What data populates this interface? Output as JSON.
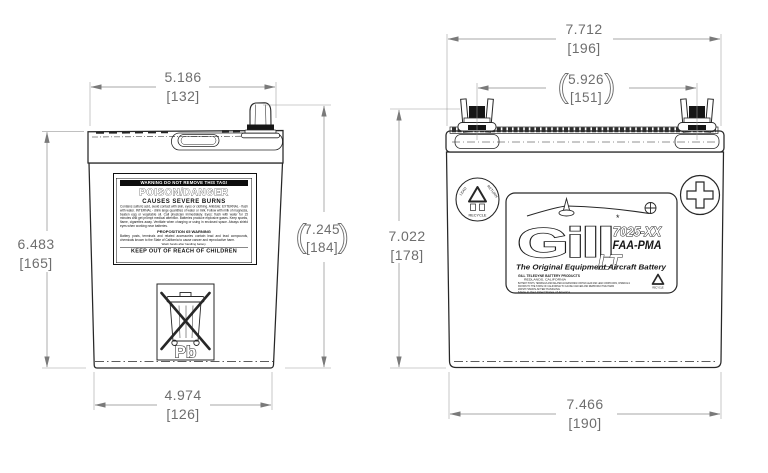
{
  "colors": {
    "line": "#272727",
    "dim_line": "#8a8a8a",
    "dim_text": "#6e6e6e",
    "black_fill": "#161616",
    "background": "#ffffff"
  },
  "glyphs": {
    "paren_open": "(",
    "paren_close": ")",
    "asterisk": "*"
  },
  "left_view": {
    "dim_top": {
      "value": "5.186",
      "mm": "[132]"
    },
    "dim_left": {
      "value": "6.483",
      "mm": "[165]"
    },
    "dim_right": {
      "value": "7.245",
      "mm": "[184]"
    },
    "dim_bottom": {
      "value": "4.974",
      "mm": "[126]"
    },
    "warning_label": {
      "header": "WARNING DO NOT REMOVE THIS TAG!",
      "title": "POISON/DANGER",
      "subtitle": "CAUSES SEVERE BURNS",
      "body": "Contains sulfuric acid, avoid contact with skin, eyes or clothing. Antidote: EXTERNAL - flush with water. INTERNAL - drink large quantities of water or milk. Follow with milk of magnesia, beaten egg or vegetable oil. Call physician immediately. Eyes: flush with water for 15 minutes and get prompt medical attention. Batteries produce explosive gases. Keep sparks, flame, cigarettes away. Ventilate when charging or using in enclosed space. Always shield eyes when working near batteries.",
      "prop65_title": "PROPOSITION 65 WARNING",
      "prop65_body": "Battery posts, terminals and related accessories contain lead and lead compounds, chemicals known to the State of California to cause cancer and reproductive harm.",
      "wash_note": "Wash hands after handling battery.",
      "footer": "KEEP OUT OF REACH OF CHILDREN"
    },
    "pb_marking": "Pb"
  },
  "right_view": {
    "dim_top": {
      "value": "7.712",
      "mm": "[196]"
    },
    "dim_terminals": {
      "value": "5.926",
      "mm": "[151]"
    },
    "dim_left": {
      "value": "7.022",
      "mm": "[178]"
    },
    "dim_bottom": {
      "value": "7.466",
      "mm": "[190]"
    },
    "product_label": {
      "brand": "Gill",
      "series": "LT",
      "model": "7025-XX",
      "certification": "FAA-PMA",
      "tagline": "The Original Equipment Aircraft Battery",
      "fine_print": [
        "GILL TELEDYNE BATTERY PRODUCTS",
        "REDLANDS, CALIFORNIA",
        "BATTERY POSTS, TERMINALS AND RELATED ACCESSORIES CONTAIN LEAD AND LEAD COMPOUNDS, CHEMICALS",
        "KNOWN TO THE STATE OF CALIFORNIA TO CAUSE CANCER AND REPRODUCTIVE HARM",
        "WASH HANDS AFTER HANDLING",
        "Made in the United States of America"
      ],
      "mini_recycle_caption": "RECYCLE"
    },
    "recycle_badge": {
      "word_left": "LEAD",
      "word_right": "RETURN",
      "word_bottom": "RECYCLE"
    }
  }
}
